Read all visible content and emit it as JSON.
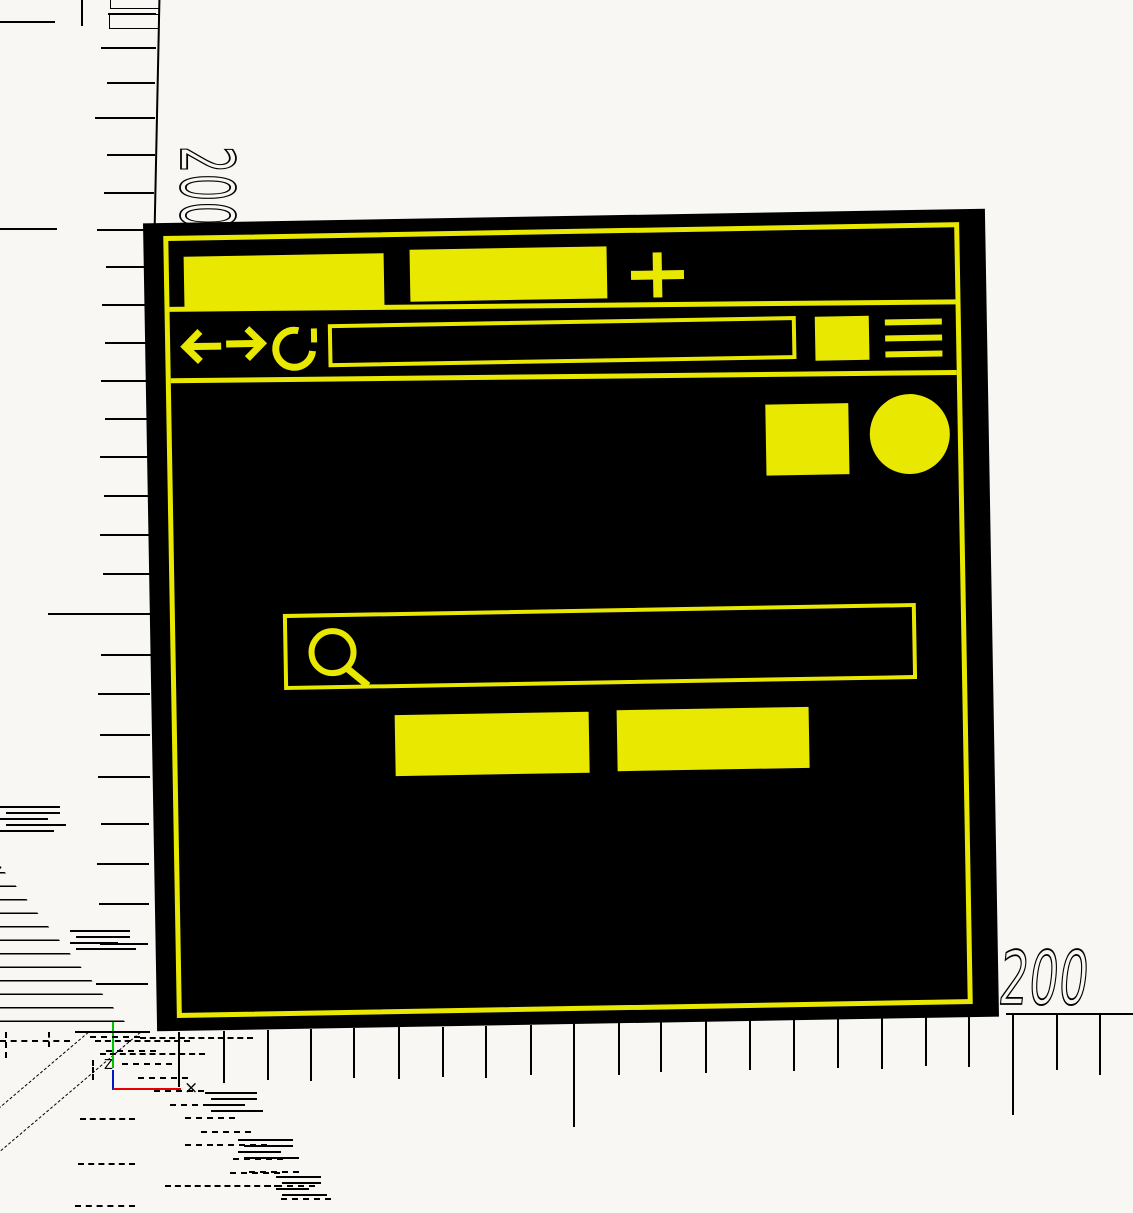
{
  "scene": {
    "description": "CAD wireframe canvas with rulers showing a browser window mockup",
    "background_color": "#f8f7f4",
    "accent_color": "#e8e800",
    "window_color": "#000000"
  },
  "rulers": {
    "left_label": "200",
    "bottom_label": "200"
  },
  "axis_tripod": {
    "z_label": "Z",
    "x_marker": "×",
    "x_axis_color": "#e80000",
    "y_axis_color": "#00c400",
    "z_axis_color": "#0018c8"
  },
  "browser_window": {
    "tabs": [
      {
        "id": "tab-1",
        "label": ""
      },
      {
        "id": "tab-2",
        "label": ""
      }
    ],
    "new_tab_icon": "plus",
    "nav_icons": [
      "back-arrow",
      "forward-arrow",
      "reload"
    ],
    "url_value": "",
    "extension_icon": "filled-square",
    "menu_icon": "hamburger",
    "content": {
      "placeholder_square": "filled-square",
      "placeholder_circle": "filled-circle",
      "search_placeholder": "",
      "search_icon": "magnifier",
      "buttons": [
        {
          "id": "button-1",
          "label": ""
        },
        {
          "id": "button-2",
          "label": ""
        }
      ]
    }
  },
  "wireframe": {
    "left_ticks": [
      {
        "y": 13,
        "len": 48
      },
      {
        "y": 47,
        "len": 55
      },
      {
        "y": 82,
        "len": 48
      },
      {
        "y": 117,
        "len": 60
      },
      {
        "y": 154,
        "len": 48
      },
      {
        "y": 192,
        "len": 50
      },
      {
        "y": 229,
        "len": 57
      },
      {
        "y": 266,
        "len": 48
      },
      {
        "y": 304,
        "len": 52
      },
      {
        "y": 342,
        "len": 48
      },
      {
        "y": 380,
        "len": 52
      },
      {
        "y": 418,
        "len": 48
      },
      {
        "y": 456,
        "len": 52
      },
      {
        "y": 495,
        "len": 48
      },
      {
        "y": 534,
        "len": 52
      },
      {
        "y": 573,
        "len": 48
      },
      {
        "y": 613,
        "len": 103
      },
      {
        "y": 654,
        "len": 50
      },
      {
        "y": 693,
        "len": 52
      },
      {
        "y": 734,
        "len": 50
      },
      {
        "y": 776,
        "len": 52
      },
      {
        "y": 823,
        "len": 48
      },
      {
        "y": 863,
        "len": 52
      },
      {
        "y": 903,
        "len": 50
      },
      {
        "y": 943,
        "len": 48
      },
      {
        "y": 983,
        "len": 52
      }
    ],
    "bottom_ticks": [
      {
        "x": 178,
        "len": 55
      },
      {
        "x": 223,
        "len": 52
      },
      {
        "x": 267,
        "len": 50
      },
      {
        "x": 310,
        "len": 52
      },
      {
        "x": 353,
        "len": 50
      },
      {
        "x": 398,
        "len": 52
      },
      {
        "x": 442,
        "len": 50
      },
      {
        "x": 485,
        "len": 52
      },
      {
        "x": 530,
        "len": 50
      },
      {
        "x": 573,
        "len": 103
      },
      {
        "x": 618,
        "len": 52
      },
      {
        "x": 660,
        "len": 50
      },
      {
        "x": 705,
        "len": 52
      },
      {
        "x": 749,
        "len": 50
      },
      {
        "x": 793,
        "len": 52
      },
      {
        "x": 837,
        "len": 50
      },
      {
        "x": 881,
        "len": 52
      },
      {
        "x": 925,
        "len": 50
      },
      {
        "x": 968,
        "len": 52
      },
      {
        "x": 1012,
        "len": 100
      },
      {
        "x": 1056,
        "len": 55
      },
      {
        "x": 1099,
        "len": 60
      }
    ],
    "solid_bars": [
      [
        0,
        21,
        55
      ],
      [
        0,
        228,
        57
      ],
      [
        75,
        1031,
        75
      ],
      [
        1006,
        1013,
        127
      ]
    ],
    "solid_vbars": [
      [
        81,
        0,
        26
      ]
    ],
    "dash_segments": [
      [
        0,
        1040,
        70
      ],
      [
        95,
        1040,
        95
      ],
      [
        100,
        1053,
        105
      ],
      [
        140,
        1037,
        113
      ],
      [
        80,
        1118,
        55
      ],
      [
        78,
        1163,
        57
      ],
      [
        75,
        1205,
        60
      ],
      [
        165,
        1185,
        115
      ],
      [
        185,
        1144,
        28
      ],
      [
        230,
        1172,
        50
      ]
    ],
    "dash_verticals": [
      [
        5,
        1032,
        26
      ],
      [
        48,
        1032,
        15
      ],
      [
        92,
        1060,
        20
      ]
    ],
    "band": {
      "x0": 90,
      "y0": 1036,
      "y1": 1210,
      "step": 13.5,
      "slope": 1.178,
      "width": 50
    },
    "clusters": [
      {
        "x": 205,
        "y": 1092,
        "n": 4,
        "w": 52
      },
      {
        "x": 238,
        "y": 1139,
        "n": 4,
        "w": 55
      },
      {
        "x": 276,
        "y": 1176,
        "n": 4,
        "w": 45
      },
      {
        "x": 0,
        "y": 806,
        "n": 5,
        "w": 60
      },
      {
        "x": 70,
        "y": 930,
        "n": 4,
        "w": 60
      }
    ]
  }
}
